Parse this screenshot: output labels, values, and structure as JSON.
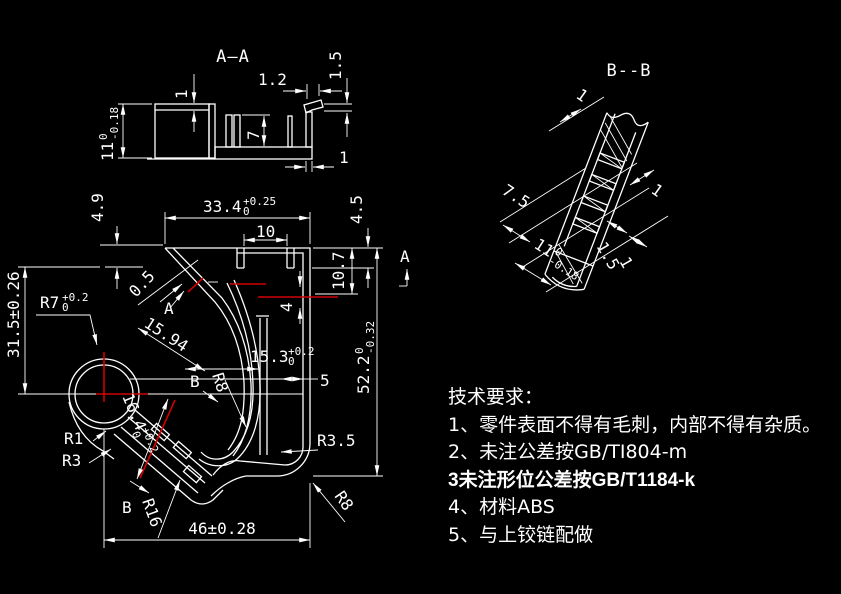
{
  "canvas": {
    "background": "#000000",
    "line_color": "#ffffff",
    "centerline_color": "#d00000"
  },
  "section_aa": {
    "title": "A—A",
    "dim_wall_top": "1",
    "dim_1_2": "1.2",
    "dim_1_5": "1.5",
    "dim_height": "11",
    "dim_height_sup": "0",
    "dim_height_sub": "-0.18",
    "dim_rib": "7",
    "dim_base": "1"
  },
  "main_view": {
    "dim_33_4": "33.4",
    "dim_33_4_sup": "+0.25",
    "dim_33_4_sub": "0",
    "dim_10": "10",
    "dim_4_9": "4.9",
    "dim_4_5": "4.5",
    "dim_10_7": "10.7",
    "dim_4": "4",
    "dim_31_5": "31.5±0.26",
    "dim_r7": "R7",
    "dim_r7_sup": "+0.2",
    "dim_r7_sub": "0",
    "dim_0_5": "0.5",
    "dim_15_94": "15.94",
    "dim_15_3": "15.3",
    "dim_15_3_sup": "+0.2",
    "dim_15_3_sub": "0",
    "dim_5": "5",
    "dim_52_2": "52.2",
    "dim_52_2_sup": "0",
    "dim_52_2_sub": "-0.32",
    "dim_16_4": "16.4",
    "dim_16_4_sup": "+0.2",
    "dim_16_4_sub": "0",
    "dim_r8_hook": "R8",
    "dim_r8_corner": "R8",
    "dim_r3_5": "R3.5",
    "dim_r1": "R1",
    "dim_r3": "R3",
    "dim_r16": "R16",
    "dim_46": "46±0.28",
    "marker_a_cut": "A",
    "marker_a_side": "A",
    "marker_b_mid": "B",
    "marker_b_bottom": "B"
  },
  "section_bb": {
    "title": "B--B",
    "dim_top": "1",
    "dim_7_5": "7.5",
    "dim_height": "11",
    "dim_height_sup": "0",
    "dim_height_sub": "-0.18",
    "dim_1_5": "1.5",
    "dim_1_side": "1",
    "dim_1_bottom": "1"
  },
  "tech_notes": {
    "title": "技术要求：",
    "line1": "1、零件表面不得有毛刺，内部不得有杂质。",
    "line2": "2、未注公差按GB/TI804-m",
    "line3": "3未注形位公差按GB/T1184-k",
    "line4": "4、材料ABS",
    "line5": "5、与上铰链配做"
  }
}
